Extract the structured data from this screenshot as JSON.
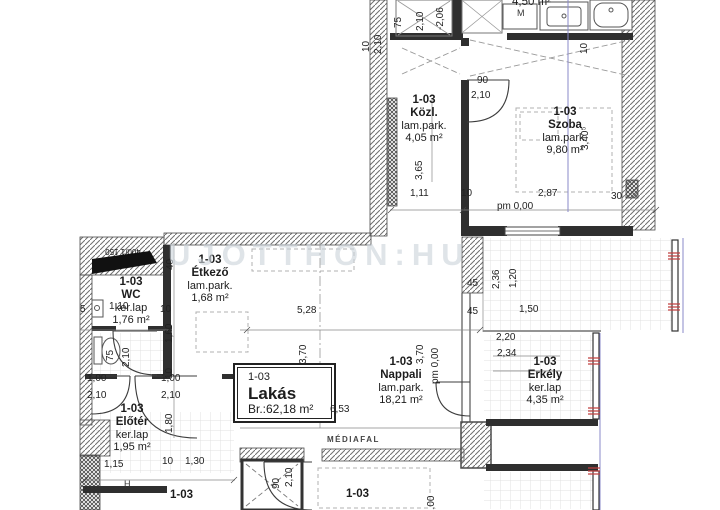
{
  "watermark": "UJOTTHON:HU",
  "unit_box": {
    "code": "1-03",
    "name": "Lakás",
    "area": "Br.:62,18 m²"
  },
  "rooms": {
    "kozl": {
      "code": "1-03",
      "name": "Közl.",
      "floor": "lam.park.",
      "area": "4,05 m²"
    },
    "szoba": {
      "code": "1-03",
      "name": "Szoba",
      "floor": "lam.park.",
      "area": "9,80 m²"
    },
    "furdo": {
      "area": "4,50 m²"
    },
    "wc": {
      "code": "1-03",
      "name": "WC",
      "floor": "ker.lap",
      "area": "1,76 m²"
    },
    "etkezo": {
      "code": "1-03",
      "name": "Étkező",
      "floor": "lam.park.",
      "area": "1,68 m²"
    },
    "eloter": {
      "code": "1-03",
      "name": "Előtér",
      "floor": "ker.lap",
      "area": "1,95 m²"
    },
    "nappali": {
      "code": "1-03",
      "name": "Nappali",
      "floor": "lam.park.",
      "area": "18,21 m²"
    },
    "erkely": {
      "code": "1-03",
      "name": "Erkély",
      "floor": "ker.lap",
      "area": "4,35 m²"
    },
    "bottom_left": {
      "code": "1-03"
    },
    "bottom_right": {
      "code": "1-03"
    }
  },
  "labels": {
    "mediafal": "MÉDIAFAL",
    "appliance_m": "M",
    "h_mark": "H",
    "section_mark": "400/1 150"
  },
  "colors": {
    "wall": "#2f2f2f",
    "hatch": "#6f6f6f",
    "section_line": "#8a8ac8",
    "red_mark": "#c04040",
    "watermark": "#ccd4db"
  },
  "dimensions": [
    {
      "t": "75",
      "x": 404,
      "y": 28,
      "r": -90
    },
    {
      "t": "2,10",
      "x": 426,
      "y": 31,
      "r": -90
    },
    {
      "t": "-2,06",
      "x": 446,
      "y": 30,
      "r": -90
    },
    {
      "t": "10",
      "x": 372,
      "y": 52,
      "r": -90
    },
    {
      "t": "2,10",
      "x": 384,
      "y": 54,
      "r": -90
    },
    {
      "t": "10",
      "x": 590,
      "y": 54,
      "r": -90
    },
    {
      "t": "90",
      "x": 477,
      "y": 86,
      "r": 0
    },
    {
      "t": "2,10",
      "x": 471,
      "y": 101,
      "r": 0
    },
    {
      "t": "3,65",
      "x": 425,
      "y": 180,
      "r": -90
    },
    {
      "t": "3,40⁵",
      "x": 591,
      "y": 150,
      "r": -90
    },
    {
      "t": "1,11",
      "x": 410,
      "y": 199,
      "r": 0
    },
    {
      "t": "10",
      "x": 461,
      "y": 199,
      "r": 0
    },
    {
      "t": "2,87",
      "x": 538,
      "y": 199,
      "r": 0
    },
    {
      "t": "30",
      "x": 611,
      "y": 202,
      "r": 0
    },
    {
      "t": "pm 0,00",
      "x": 497,
      "y": 212,
      "r": 0
    },
    {
      "t": "40",
      "x": 176,
      "y": 270,
      "r": -90
    },
    {
      "t": "1,60",
      "x": 175,
      "y": 343,
      "r": -90
    },
    {
      "t": "5",
      "x": 80,
      "y": 315,
      "r": 0
    },
    {
      "t": "1,10",
      "x": 109,
      "y": 312,
      "r": 0
    },
    {
      "t": "10",
      "x": 160,
      "y": 315,
      "r": 0
    },
    {
      "t": "75",
      "x": 116,
      "y": 361,
      "r": -90
    },
    {
      "t": "2,10",
      "x": 132,
      "y": 367,
      "r": -90
    },
    {
      "t": "5,28",
      "x": 297,
      "y": 316,
      "r": 0
    },
    {
      "t": "3,70",
      "x": 309,
      "y": 364,
      "r": -90
    },
    {
      "t": "3,70",
      "x": 426,
      "y": 364,
      "r": -90
    },
    {
      "t": "pm 0,00",
      "x": 441,
      "y": 384,
      "r": -90
    },
    {
      "t": "45",
      "x": 467,
      "y": 289,
      "r": 0
    },
    {
      "t": "45",
      "x": 467,
      "y": 317,
      "r": 0
    },
    {
      "t": "2,36",
      "x": 502,
      "y": 289,
      "r": -90
    },
    {
      "t": "1,20",
      "x": 519,
      "y": 288,
      "r": -90
    },
    {
      "t": "1,50",
      "x": 519,
      "y": 315,
      "r": 0
    },
    {
      "t": "2,20",
      "x": 496,
      "y": 343,
      "r": 0
    },
    {
      "t": "2,34",
      "x": 497,
      "y": 359,
      "r": 0
    },
    {
      "t": "6,53",
      "x": 330,
      "y": 415,
      "r": 0
    },
    {
      "t": "1,00",
      "x": 87,
      "y": 384,
      "r": 0
    },
    {
      "t": "2,10",
      "x": 87,
      "y": 401,
      "r": 0
    },
    {
      "t": "1,00",
      "x": 161,
      "y": 384,
      "r": 0
    },
    {
      "t": "2,10",
      "x": 161,
      "y": 401,
      "r": 0
    },
    {
      "t": "1,80",
      "x": 175,
      "y": 433,
      "r": -90
    },
    {
      "t": "10",
      "x": 175,
      "y": 379,
      "r": -90
    },
    {
      "t": "1,15",
      "x": 104,
      "y": 470,
      "r": 0
    },
    {
      "t": "10",
      "x": 162,
      "y": 467,
      "r": 0
    },
    {
      "t": "1,30",
      "x": 185,
      "y": 467,
      "r": 0
    },
    {
      "t": "90",
      "x": 282,
      "y": 489,
      "r": -90
    },
    {
      "t": "2,10",
      "x": 295,
      "y": 487,
      "r": -90
    },
    {
      "t": "1,00",
      "x": 437,
      "y": 515,
      "r": -90
    }
  ]
}
